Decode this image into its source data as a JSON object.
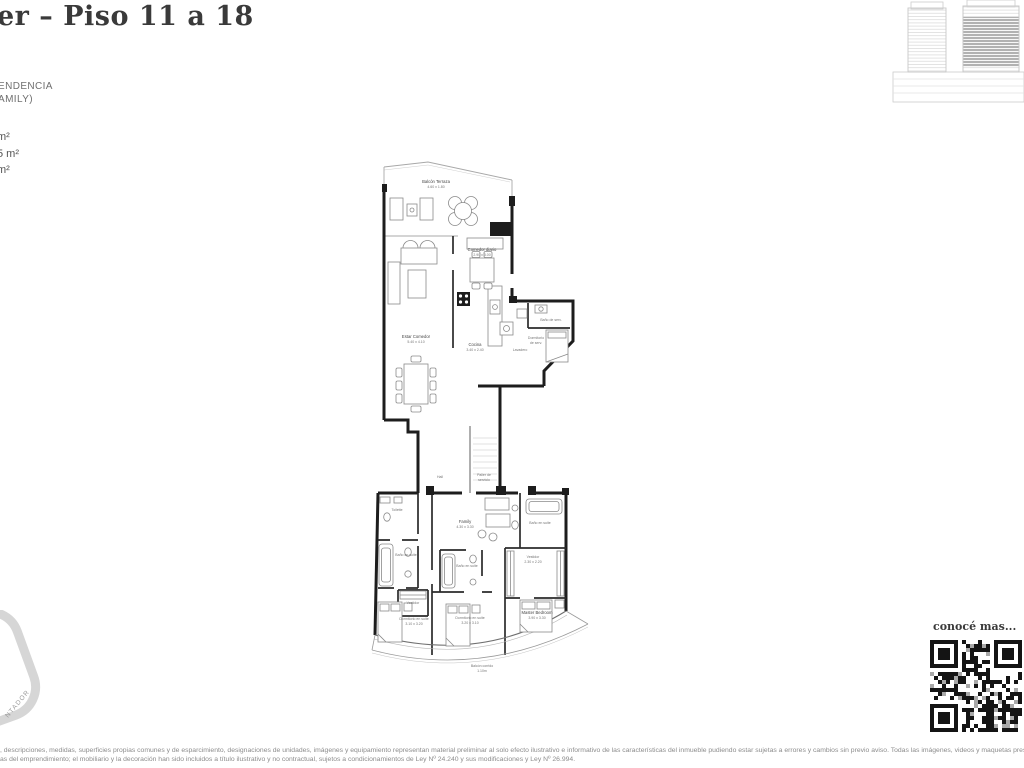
{
  "header": {
    "title": "er – Piso 11 a 18"
  },
  "unit": {
    "type_line1": "ENDENCIA",
    "type_line2": "AMILY)",
    "areas": [
      "m²",
      "5 m²",
      "m²"
    ]
  },
  "plan": {
    "balcon_terraza": {
      "name": "Balcón Terraza",
      "dims": "4.60 x 1.80"
    },
    "estar_comedor": {
      "name": "Estar Comedor",
      "dims": "5.40 x 4.10"
    },
    "comedor_diario": {
      "name": "Comedor diario",
      "dims": "2.90 x 3.00"
    },
    "cocina": {
      "name": "Cocina",
      "dims": "3.40 x 2.40"
    },
    "lavadero": {
      "name": "Lavadero"
    },
    "bano_serv": {
      "name": "Baño de serv."
    },
    "dorm_serv": {
      "line1": "Dormitorio",
      "line2": "de serv."
    },
    "hall": {
      "name": "Hall"
    },
    "palier": {
      "line1": "Palier de",
      "line2": "servicio"
    },
    "toilette": {
      "name": "Toilette"
    },
    "family": {
      "name": "Family",
      "dims": "4.30 x 3.30"
    },
    "bano_suite": "Baño en suite",
    "vestidor": "Vestidor",
    "vestidor_dims": "2.30 x 2.20",
    "dorm_suite_izq": {
      "name": "Dormitorio en suite",
      "dims": "3.10 x 3.20"
    },
    "dorm_suite_ctr": {
      "name": "Dormitorio en suite",
      "dims": "3.20 x 3.10"
    },
    "master": {
      "name": "Master Bedroom",
      "dims": "3.90 x 3.30"
    },
    "balcon_corrido": {
      "name": "Balcón corrido",
      "dims": "1.10m"
    }
  },
  "qr": {
    "caption": "conocé mas..."
  },
  "stamp": {
    "text": "NTADOR"
  },
  "footer": {
    "line1": ", descripciones, medidas, superficies propias comunes y de esparcimiento, designaciones de unidades, imágenes y equipamiento representan material preliminar al solo efecto ilustrativo e informativo de las características del inmueble pudiendo estar sujetas a errores y cambios sin previo aviso. Todas las imágenes, videos y maquetas presentadas como material",
    "line2": "as del emprendimiento; el mobiliario y la decoración han sido incluidos a título ilustrativo y no contractual, sujetos a condicionamientos de Ley Nº 24.240 y sus modificaciones y Ley Nº 26.994."
  }
}
